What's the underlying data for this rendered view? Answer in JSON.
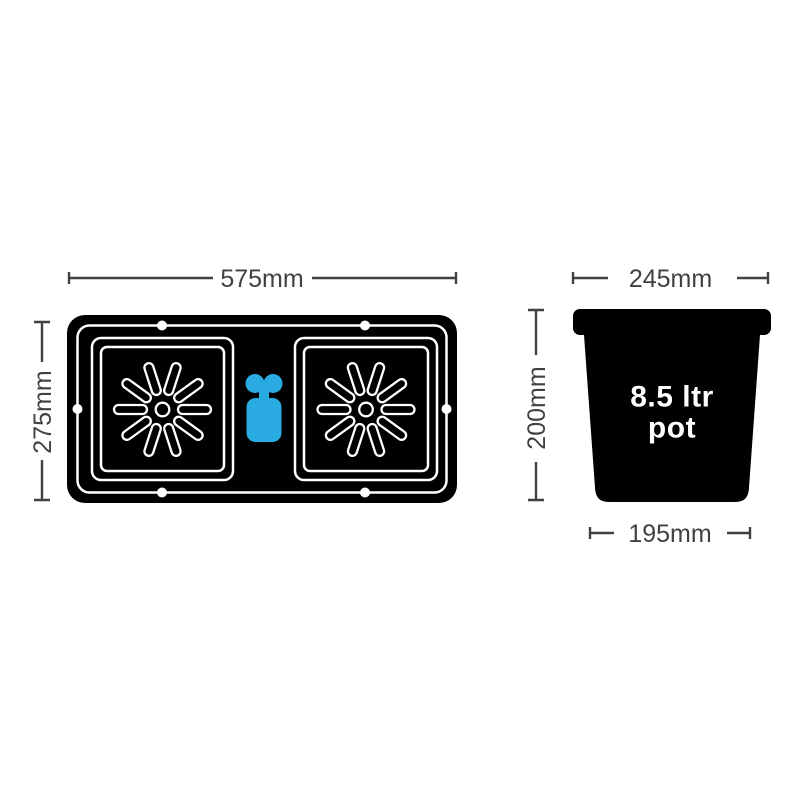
{
  "background": "#ffffff",
  "colors": {
    "shape_ink": "#000000",
    "dimension_gray": "#414042",
    "valve_blue": "#29abe2",
    "outline_white": "#ffffff"
  },
  "tray": {
    "width_label": "575mm",
    "height_label": "275mm"
  },
  "pot": {
    "top_width_label": "245mm",
    "height_label": "200mm",
    "base_width_label": "195mm",
    "volume_label": {
      "line1": "8.5 ltr",
      "line2": "pot"
    }
  },
  "icons": {
    "starburst": "starburst-icon",
    "valve": "aquavalve-icon",
    "hole": "hole-dot-icon"
  }
}
